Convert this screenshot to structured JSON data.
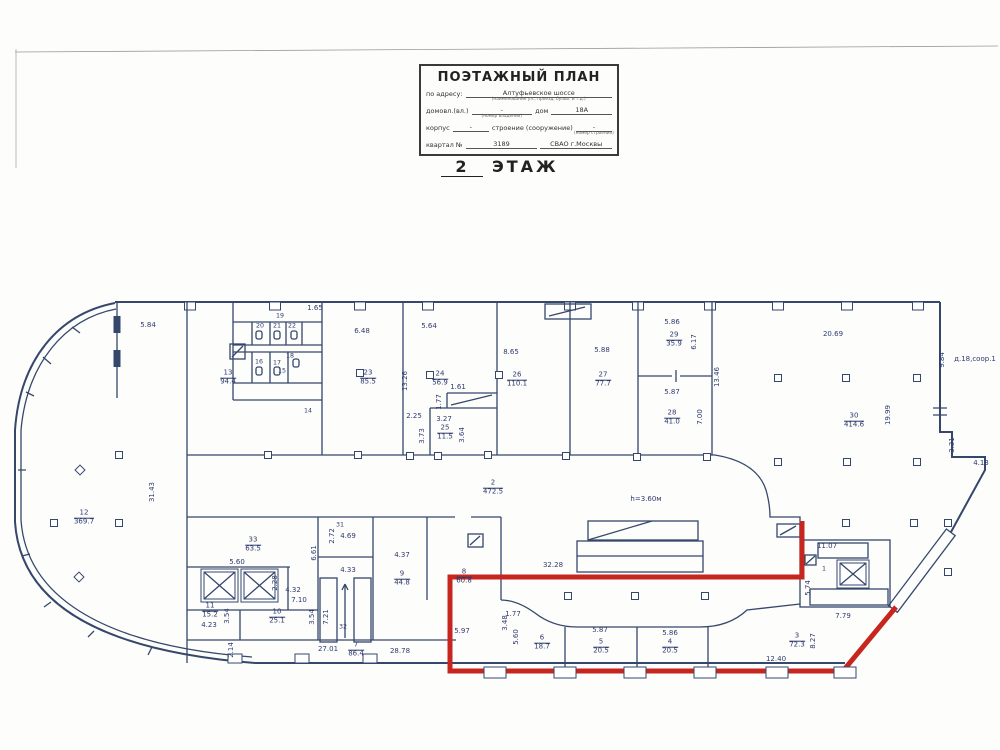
{
  "title_block": {
    "title": "ПОЭТАЖНЫЙ ПЛАН",
    "address_label": "по адресу:",
    "address_value": "Алтуфьевское шоссе",
    "address_sub": "(наименование ул., проезд, бульв. и т.д.)",
    "ownership_label": "домовл.(вл.)",
    "ownership_sub": "(номер владения)",
    "ownership_value": "-",
    "house_label": "дом",
    "house_value": "18А",
    "korpus_label": "корпус",
    "korpus_value": "-",
    "stroenie_label": "строение (сооружение)",
    "stroenie_sub": "(номер строения)",
    "stroenie_value": "-",
    "kvartal_label": "квартал №",
    "kvartal_value": "3189",
    "district": "СВАО г.Москвы"
  },
  "floor_title": {
    "number": "2",
    "word": "ЭТАЖ"
  },
  "plan": {
    "colors": {
      "wall": "#35476b",
      "red_outline": "#c6261d",
      "label": "#2e3a6e"
    },
    "rooms": [
      {
        "no": "13",
        "area": "94.4",
        "x": 228,
        "y": 378
      },
      {
        "no": "23",
        "area": "85.5",
        "x": 368,
        "y": 378
      },
      {
        "no": "24",
        "area": "56.9",
        "x": 440,
        "y": 379
      },
      {
        "no": "25",
        "area": "11.5",
        "x": 445,
        "y": 433
      },
      {
        "no": "26",
        "area": "110.1",
        "x": 517,
        "y": 380
      },
      {
        "no": "27",
        "area": "77.7",
        "x": 603,
        "y": 380
      },
      {
        "no": "29",
        "area": "35.9",
        "x": 674,
        "y": 340
      },
      {
        "no": "28",
        "area": "41.0",
        "x": 672,
        "y": 418
      },
      {
        "no": "30",
        "area": "414.6",
        "x": 854,
        "y": 421
      },
      {
        "no": "12",
        "area": "369.7",
        "x": 84,
        "y": 518
      },
      {
        "no": "2",
        "area": "472.5",
        "x": 493,
        "y": 488
      },
      {
        "no": "33",
        "area": "63.5",
        "x": 253,
        "y": 545
      },
      {
        "no": "11",
        "area": "15.2",
        "x": 210,
        "y": 611
      },
      {
        "no": "10",
        "area": "25.1",
        "x": 277,
        "y": 617
      },
      {
        "no": "9",
        "area": "44.8",
        "x": 402,
        "y": 579
      },
      {
        "no": "7",
        "area": "86.4",
        "x": 356,
        "y": 650
      },
      {
        "no": "8",
        "area": "60.8",
        "x": 464,
        "y": 577
      },
      {
        "no": "6",
        "area": "18.7",
        "x": 542,
        "y": 643
      },
      {
        "no": "5",
        "area": "20.5",
        "x": 601,
        "y": 647
      },
      {
        "no": "4",
        "area": "20.5",
        "x": 670,
        "y": 647
      },
      {
        "no": "3",
        "area": "72.3",
        "x": 797,
        "y": 641
      }
    ],
    "small_rooms": [
      {
        "no": "14",
        "x": 308,
        "y": 412
      },
      {
        "no": "15",
        "x": 282,
        "y": 372
      },
      {
        "no": "16",
        "x": 259,
        "y": 363
      },
      {
        "no": "17",
        "x": 277,
        "y": 364
      },
      {
        "no": "18",
        "x": 290,
        "y": 357
      },
      {
        "no": "19",
        "x": 280,
        "y": 317
      },
      {
        "no": "20",
        "x": 260,
        "y": 327
      },
      {
        "no": "21",
        "x": 277,
        "y": 327
      },
      {
        "no": "22",
        "x": 292,
        "y": 327
      },
      {
        "no": "31",
        "x": 340,
        "y": 526
      },
      {
        "no": "32",
        "x": 343,
        "y": 628
      },
      {
        "no": "1",
        "x": 824,
        "y": 570
      }
    ],
    "dims": [
      {
        "v": "5.84",
        "x": 148,
        "y": 326
      },
      {
        "v": "1.65",
        "x": 315,
        "y": 309
      },
      {
        "v": "6.48",
        "x": 362,
        "y": 332
      },
      {
        "v": "5.64",
        "x": 429,
        "y": 327
      },
      {
        "v": "8.65",
        "x": 511,
        "y": 353
      },
      {
        "v": "5.88",
        "x": 602,
        "y": 351
      },
      {
        "v": "5.86",
        "x": 672,
        "y": 323
      },
      {
        "v": "6.17",
        "x": 695,
        "y": 342,
        "rot": 1
      },
      {
        "v": "5.87",
        "x": 672,
        "y": 393
      },
      {
        "v": "7.00",
        "x": 701,
        "y": 417,
        "rot": 1
      },
      {
        "v": "13.46",
        "x": 718,
        "y": 377,
        "rot": 1
      },
      {
        "v": "20.69",
        "x": 833,
        "y": 335
      },
      {
        "v": "19.99",
        "x": 889,
        "y": 415,
        "rot": 1
      },
      {
        "v": "9.84",
        "x": 943,
        "y": 360,
        "rot": 1
      },
      {
        "v": "д.18,соор.1",
        "x": 975,
        "y": 360
      },
      {
        "v": "3.31",
        "x": 953,
        "y": 445,
        "rot": 1
      },
      {
        "v": "4.13",
        "x": 981,
        "y": 464
      },
      {
        "v": "13.26",
        "x": 406,
        "y": 381,
        "rot": 1
      },
      {
        "v": "2.25",
        "x": 414,
        "y": 417
      },
      {
        "v": "3.73",
        "x": 423,
        "y": 436,
        "rot": 1
      },
      {
        "v": "3.27",
        "x": 444,
        "y": 420
      },
      {
        "v": "1.77",
        "x": 440,
        "y": 402,
        "rot": 1
      },
      {
        "v": "1.61",
        "x": 458,
        "y": 388
      },
      {
        "v": "3.64",
        "x": 463,
        "y": 435,
        "rot": 1
      },
      {
        "v": "31.43",
        "x": 153,
        "y": 492,
        "rot": 1
      },
      {
        "v": "h=3.60м",
        "x": 646,
        "y": 500
      },
      {
        "v": "32.28",
        "x": 553,
        "y": 566
      },
      {
        "v": "5.60",
        "x": 237,
        "y": 563
      },
      {
        "v": "2.28",
        "x": 276,
        "y": 583,
        "rot": 1
      },
      {
        "v": "4.32",
        "x": 293,
        "y": 591
      },
      {
        "v": "7.10",
        "x": 299,
        "y": 601
      },
      {
        "v": "3.54",
        "x": 228,
        "y": 616,
        "rot": 1
      },
      {
        "v": "3.54",
        "x": 313,
        "y": 617,
        "rot": 1
      },
      {
        "v": "4.23",
        "x": 209,
        "y": 626
      },
      {
        "v": "2.14",
        "x": 232,
        "y": 650,
        "rot": 1
      },
      {
        "v": "6.61",
        "x": 315,
        "y": 553,
        "rot": 1
      },
      {
        "v": "2.72",
        "x": 333,
        "y": 536,
        "rot": 1
      },
      {
        "v": "4.69",
        "x": 348,
        "y": 537
      },
      {
        "v": "4.33",
        "x": 348,
        "y": 571
      },
      {
        "v": "7.21",
        "x": 327,
        "y": 617,
        "rot": 1
      },
      {
        "v": "4.37",
        "x": 402,
        "y": 556
      },
      {
        "v": "27.01",
        "x": 328,
        "y": 650
      },
      {
        "v": "28.78",
        "x": 400,
        "y": 652
      },
      {
        "v": "5.97",
        "x": 462,
        "y": 632
      },
      {
        "v": "3.48",
        "x": 506,
        "y": 623,
        "rot": 1
      },
      {
        "v": "5.60",
        "x": 517,
        "y": 637,
        "rot": 1
      },
      {
        "v": "1.77",
        "x": 513,
        "y": 615
      },
      {
        "v": "5.87",
        "x": 600,
        "y": 631
      },
      {
        "v": "5.86",
        "x": 670,
        "y": 634
      },
      {
        "v": "5.74",
        "x": 809,
        "y": 588,
        "rot": 1
      },
      {
        "v": "11.07",
        "x": 827,
        "y": 547
      },
      {
        "v": "7.79",
        "x": 843,
        "y": 617
      },
      {
        "v": "8.27",
        "x": 814,
        "y": 641,
        "rot": 1
      },
      {
        "v": "12.40",
        "x": 776,
        "y": 660
      }
    ]
  }
}
